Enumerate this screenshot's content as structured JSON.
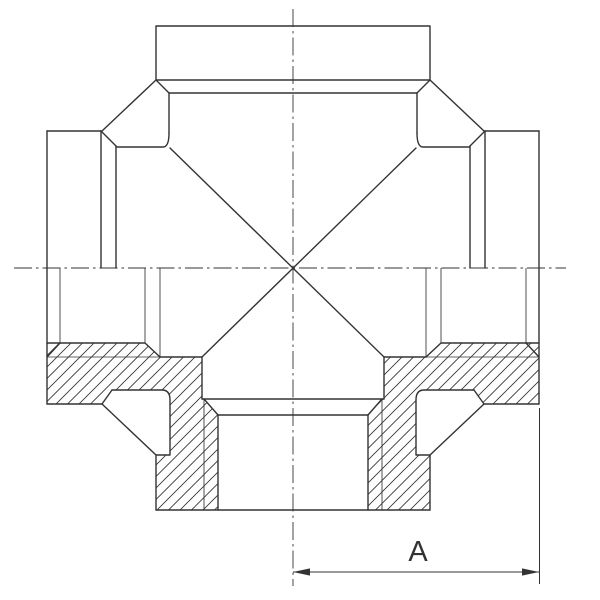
{
  "drawing": {
    "description": "Technical section drawing of a four-way cross pipe fitting, top half external view, bottom half sectioned",
    "background_color": "#ffffff",
    "line_color": "#333333",
    "dimension": {
      "label": "A"
    },
    "geometry": {
      "centerlines": [
        "M14,268 L566,268",
        "M293,9 L293,586"
      ],
      "hatch_polygons": [
        "M47,343 L145,343 L160,357 L202,357 L202,399 L204,399 L218,415 L218,510 L156,510 L156,455 L170,455 L170,400 Q170,390 162,390 L112,390 L102,404 L47,404 Z",
        "M539,343 L441,343 L426,357 L384,357 L384,399 L382,399 L368,415 L368,510 L430,510 L430,455 L416,455 L416,400 Q416,390 424,390 L474,390 L484,404 L539,404 Z"
      ],
      "thin_lines": [
        "M47,357 L160,357",
        "M426,357 L539,357",
        "M204,399 L204,510",
        "M382,399 L382,510",
        "M60,268 L60,343",
        "M526,268 L526,343",
        "M145,268 L145,343",
        "M160,268 L160,357",
        "M441,268 L441,343",
        "M426,268 L426,357"
      ],
      "outline_paths": [
        "M156,26 L430,26 L430,80 L156,80 Z",
        "M169,93 L417,93",
        "M156,80 L169,93",
        "M430,80 L417,93",
        "M169,93 L169,133",
        "M417,93 L417,133",
        "M116,147 L163,147 Q169,147 169,133",
        "M470,147 L423,147 Q417,147 417,133",
        "M156,80 L102,131",
        "M430,80 L484,131",
        "M47,131 L101,131",
        "M47,131 L47,404",
        "M101,131 L101,268",
        "M101,131 L116,146",
        "M116,146 L116,268",
        "M539,131 L485,131",
        "M539,131 L539,404",
        "M485,131 L485,268",
        "M485,131 L470,146",
        "M470,146 L470,268",
        "M170,148 L384,357",
        "M416,148 L202,357",
        "M47,343 L145,343 L160,357",
        "M160,357 L202,357 L202,399",
        "M47,357 L60,343",
        "M47,404 L102,404",
        "M102,404 L112,390",
        "M112,390 L162,390 Q170,390 170,400 L170,455 L156,455 L156,510",
        "M102,404 L156,455",
        "M539,343 L441,343 L426,357",
        "M426,357 L384,357 L384,399",
        "M539,357 L526,343",
        "M539,404 L484,404",
        "M484,404 L474,390",
        "M474,390 L424,390 Q416,390 416,400 L416,455 L430,455 L430,510",
        "M484,404 L430,455",
        "M202,399 L384,399",
        "M204,399 L218,415",
        "M382,399 L368,415",
        "M218,415 L368,415",
        "M218,415 L218,510",
        "M368,415 L368,510",
        "M156,510 L430,510"
      ],
      "dimension_lines": [
        "M293,572 L539,572",
        "M539.5,408 L539.5,584"
      ],
      "arrowheads": [
        "293,572 310,568.4 310,575.6",
        "539,572 522,568.4 522,575.6"
      ],
      "label_x": 418,
      "label_y": 561
    }
  }
}
